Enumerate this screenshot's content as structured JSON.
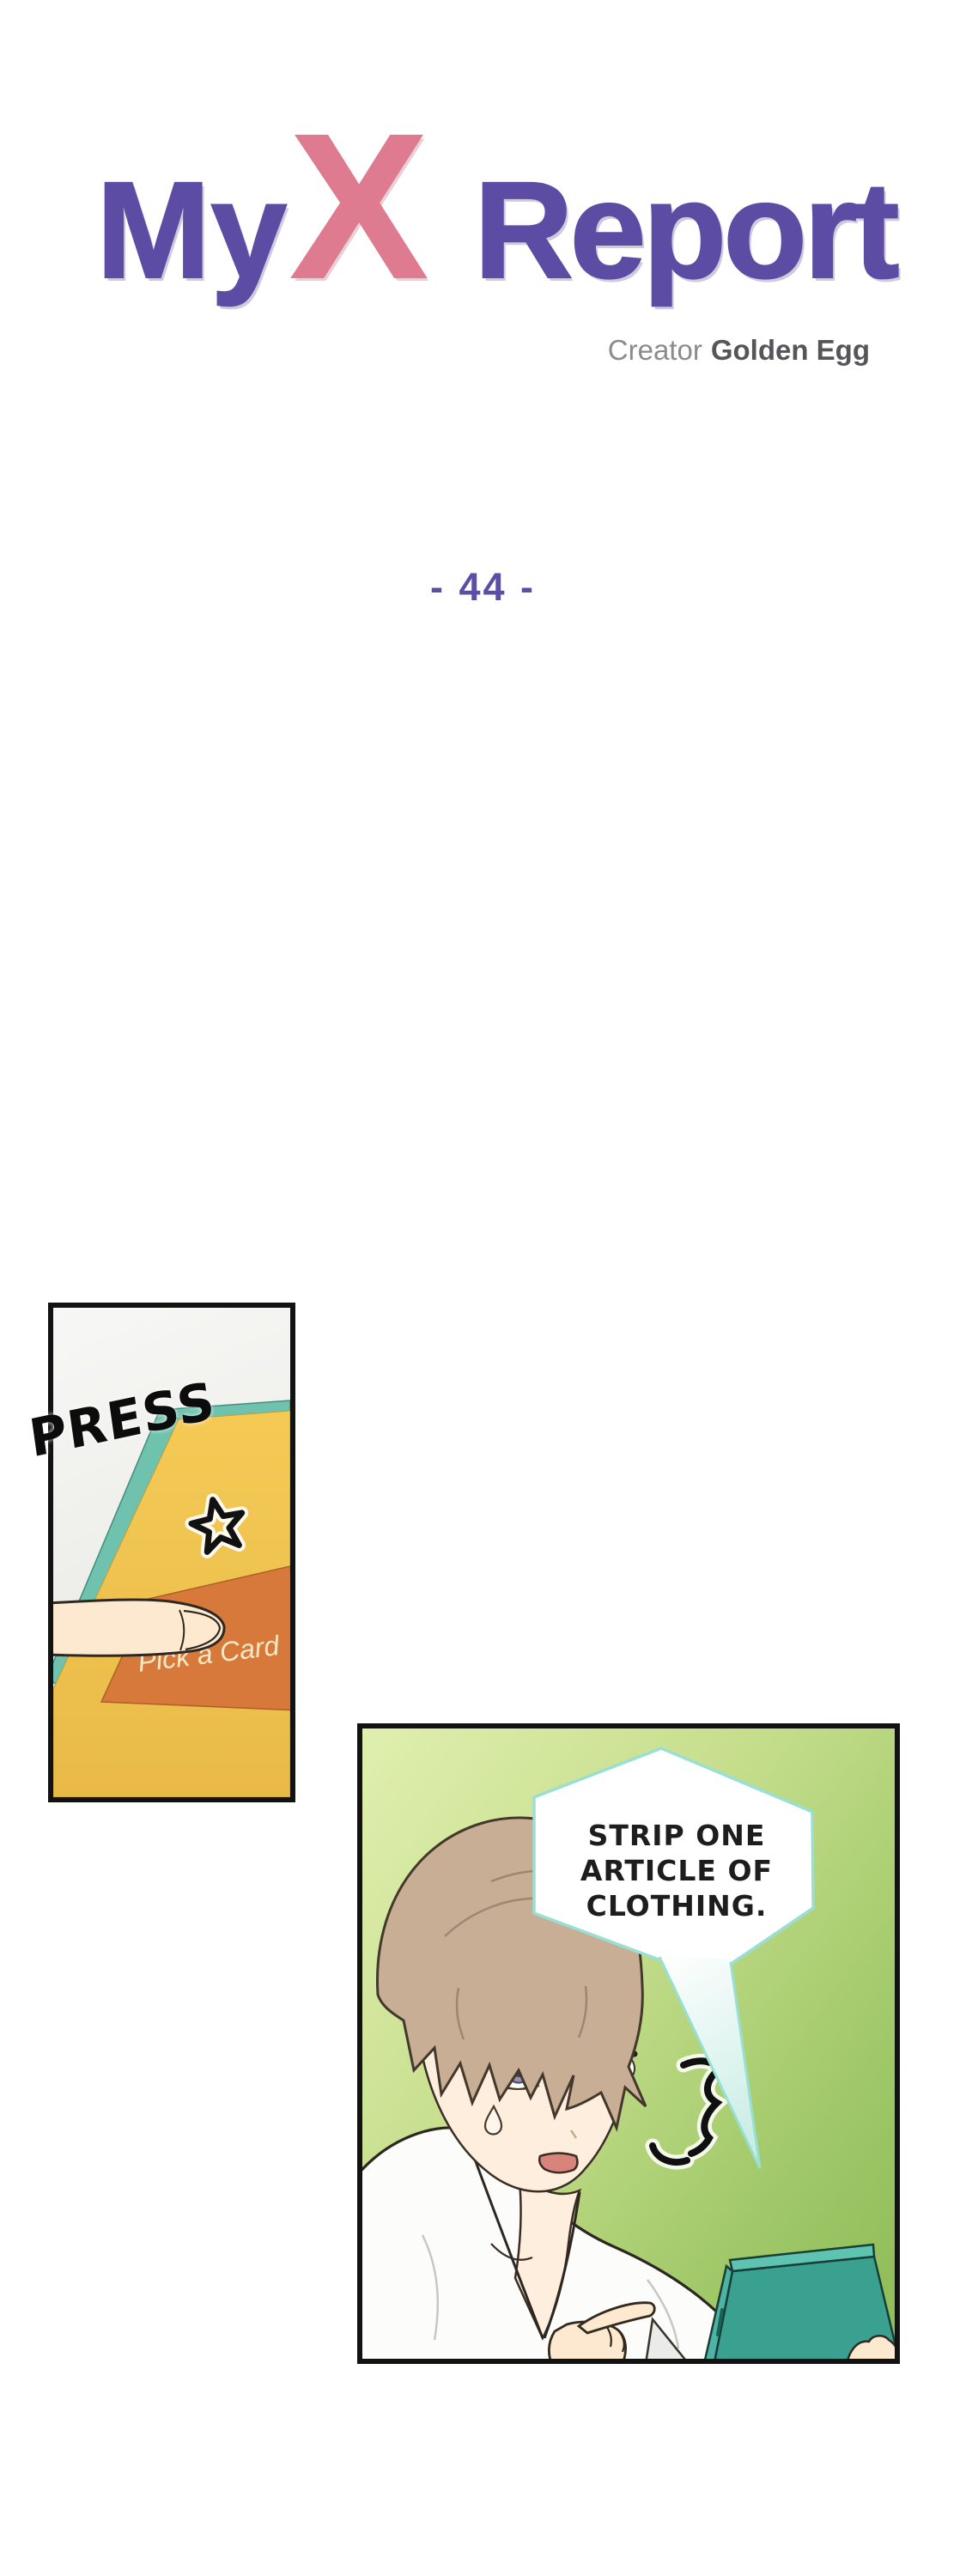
{
  "header": {
    "title": {
      "my": "My",
      "x": "X",
      "report": "Report",
      "main_color": "#5d4ca4",
      "x_color": "#df7b90"
    },
    "creator": {
      "label": "Creator",
      "name": "Golden Egg"
    },
    "chapter": "- 44 -"
  },
  "panel1": {
    "sfx": "PRESS",
    "button_label": "Pick a Card",
    "colors": {
      "background": "#efefec",
      "board": "#f3c853",
      "rim": "#6ec2ae",
      "button": "#d7793a",
      "button_text": "#f6e8c6",
      "finger_skin": "#fce9cf",
      "sfx_color": "#0c0c0c",
      "star": "#111111"
    },
    "icons": [
      "star-icon"
    ]
  },
  "panel2": {
    "bubble": {
      "text": "STRIP ONE\nARTICLE OF\nCLOTHING.",
      "fill": "#ffffff",
      "border_color": "#9adfd3",
      "text_color": "#1d1d1d"
    },
    "colors": {
      "background_top": "#e0efae",
      "background_bottom": "#92bf5c",
      "hair": "#c7ae95",
      "skin": "#fdeede",
      "robe": "#fcfcfa",
      "eye_iris": "#9a92b4",
      "mouth": "#d8837b",
      "tablet_front": "#3aa08f",
      "tablet_side": "#4db3a3",
      "shock_mark": "#101010"
    },
    "icons": [
      "shock-mark-icon"
    ]
  }
}
